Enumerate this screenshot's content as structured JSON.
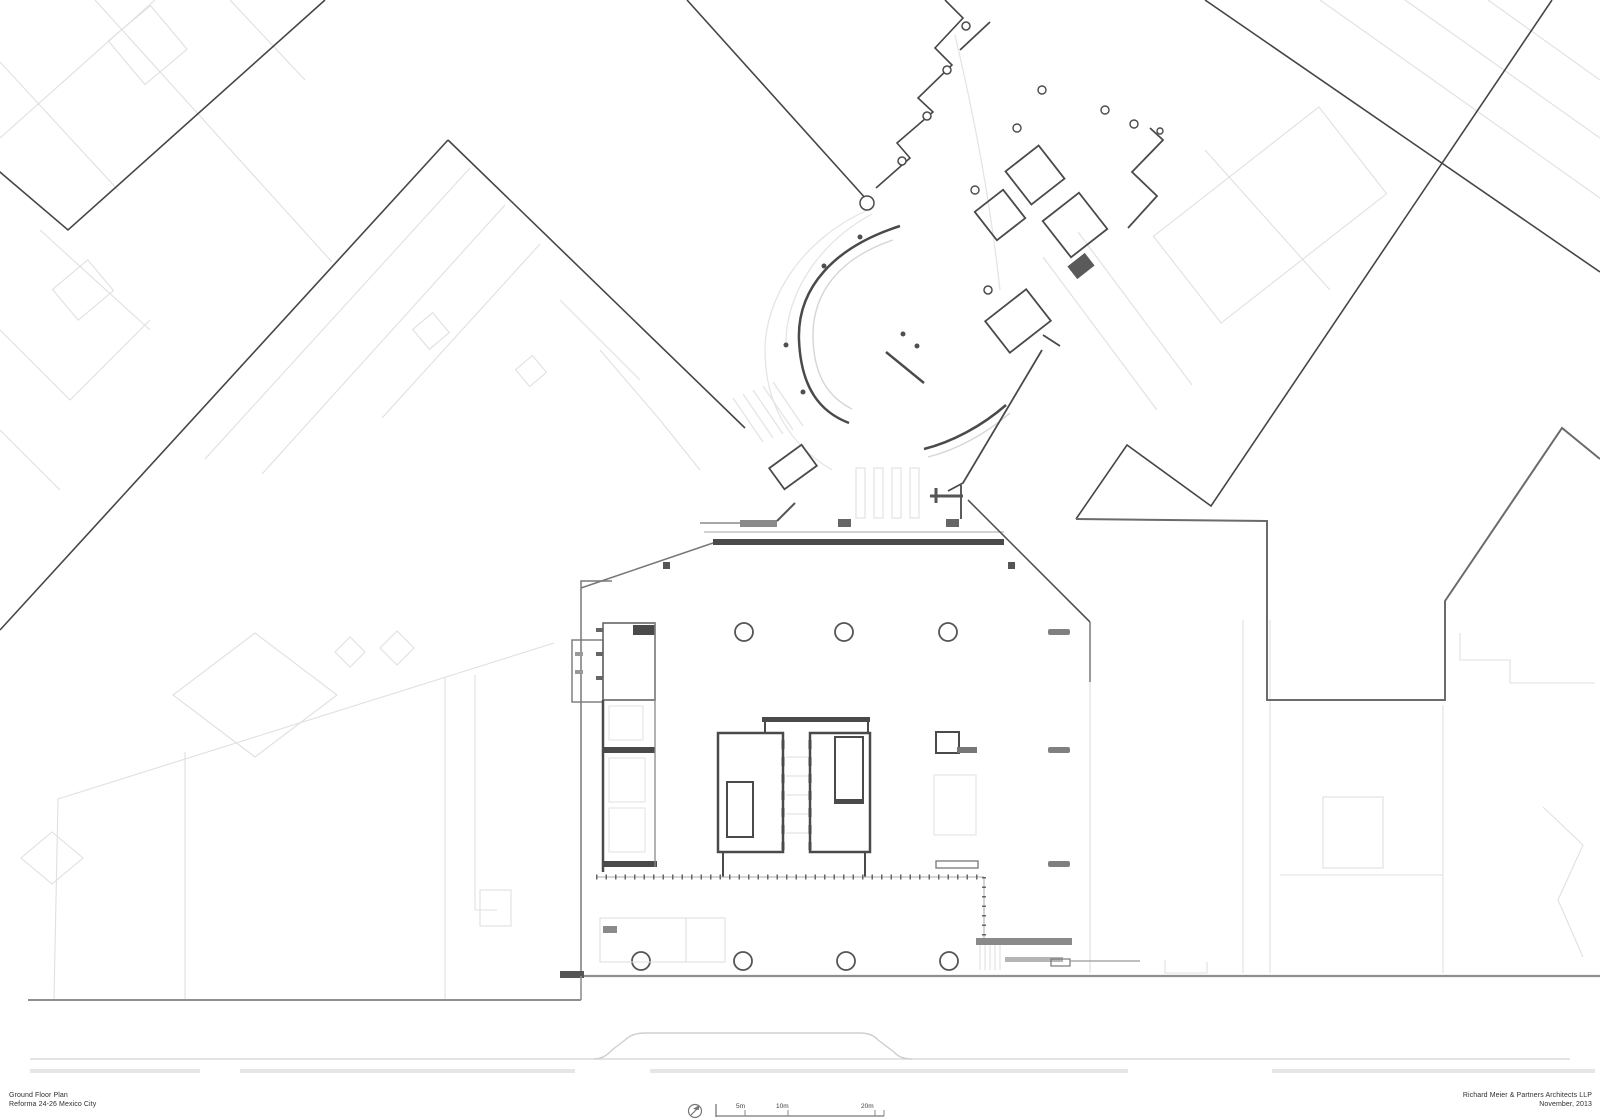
{
  "sheet": {
    "background_color": "#ffffff",
    "line_colors": {
      "primary_dark": "#464646",
      "wall_fill": "#4a4a4a",
      "street_gray": "#8f8f8f",
      "background_light": "#dedede"
    }
  },
  "title_block_left": {
    "line1": "Ground Floor Plan",
    "line2": "Reforma 24-26 Mexico City"
  },
  "title_block_right": {
    "line1": "Richard Meier & Partners Architects LLP",
    "line2": "November, 2013"
  },
  "scale_bar": {
    "labels": {
      "m5": "5m",
      "m10": "10m",
      "m20": "20m"
    }
  }
}
